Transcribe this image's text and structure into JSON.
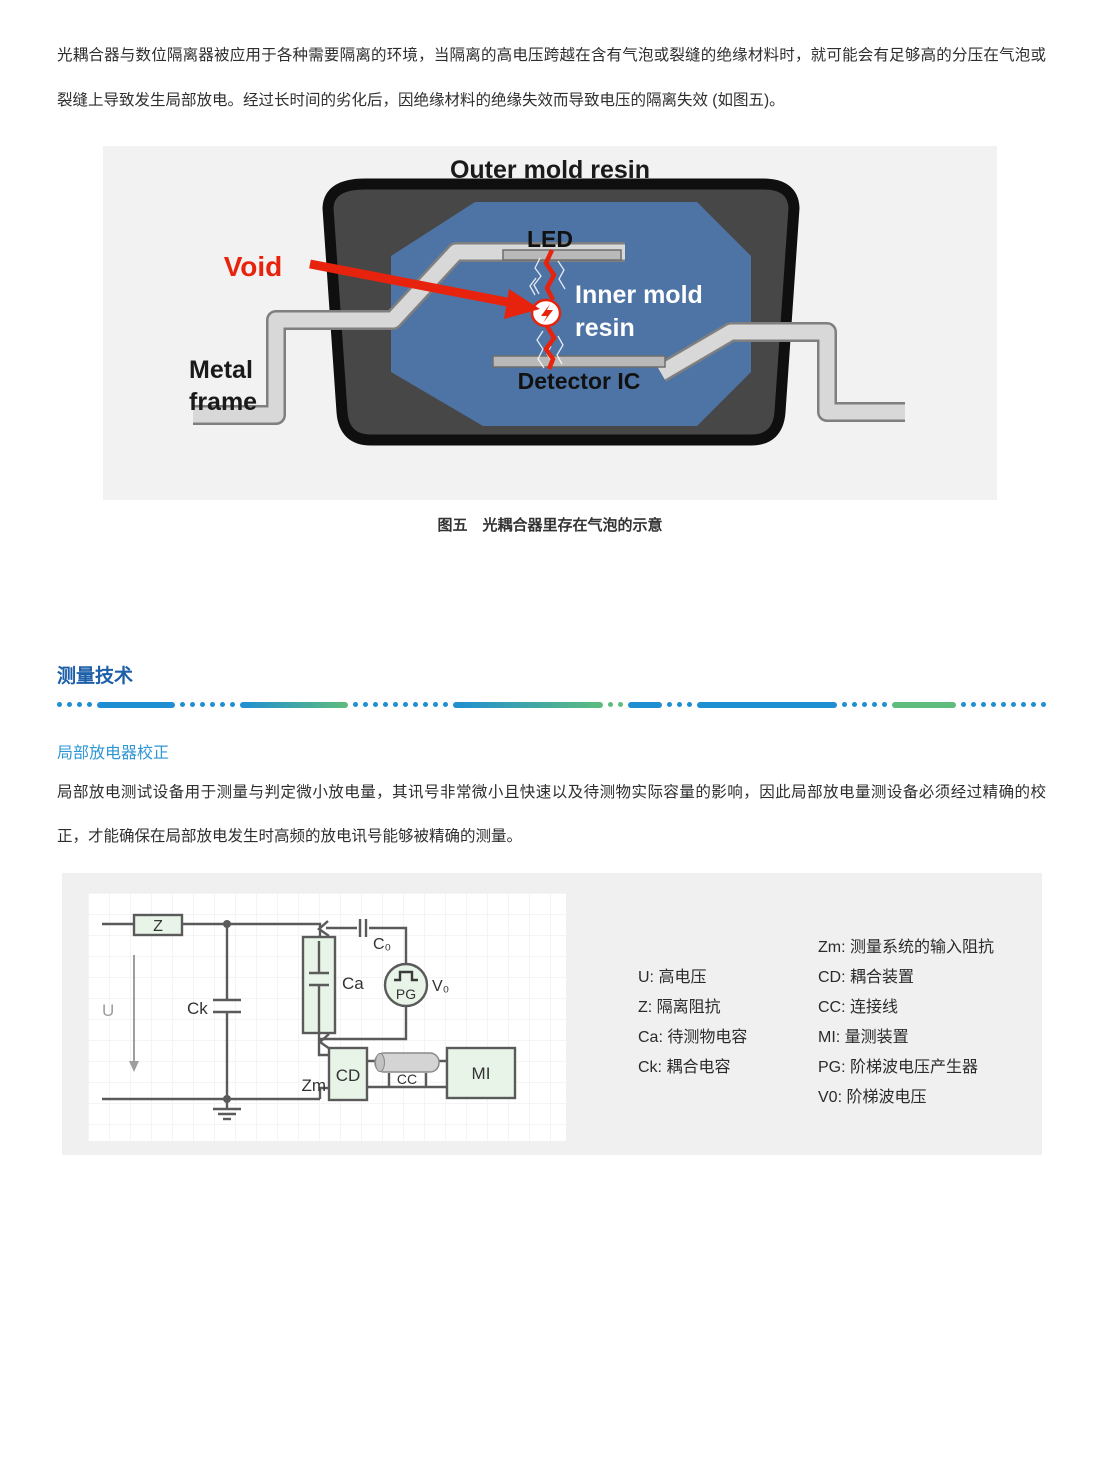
{
  "colors": {
    "section_blue": "#1d5fa9",
    "subsection_blue": "#2e96d5",
    "divider_blue": "#1f8fd2",
    "divider_green": "#5fbc7d",
    "figure_panel_gray": "#f2f2f2",
    "package_dark": "#474747",
    "inner_mold_blue": "#4d74a5",
    "metal_gray": "#d8d8d8",
    "alert_red": "#e8230d",
    "circuit_panel_gray": "#f0f0f0",
    "component_green": "#e9f4e8",
    "wire_gray": "#5a5a5a"
  },
  "intro_paragraph": "光耦合器与数位隔离器被应用于各种需要隔离的环境，当隔离的高电压跨越在含有气泡或裂缝的绝缘材料时，就可能会有足够高的分压在气泡或裂缝上导致发生局部放电。经过长时间的劣化后，因绝缘材料的绝缘失效而导致电压的隔离失效 (如图五)。",
  "figure5": {
    "title": "Outer mold resin",
    "led": "LED",
    "void": "Void",
    "inner_line1": "Inner mold",
    "inner_line2": "resin",
    "metal_line1": "Metal",
    "metal_line2": "frame",
    "detector": "Detector IC",
    "caption": "图五　光耦合器里存在气泡的示意"
  },
  "section": {
    "title": "测量技术",
    "subtitle": "局部放电器校正",
    "paragraph": "局部放电测试设备用于测量与判定微小放电量，其讯号非常微小且快速以及待测物实际容量的影响，因此局部放电量测设备必须经过精确的校正，才能确保在局部放电发生时高频的放电讯号能够被精确的测量。"
  },
  "circuit": {
    "z": "Z",
    "u": "U",
    "ck": "Ck",
    "ca": "Ca",
    "c0": "C₀",
    "pg": "PG",
    "v0": "V₀",
    "zm": "Zm",
    "cd": "CD",
    "cc": "CC",
    "mi": "MI"
  },
  "legend": {
    "left": [
      {
        "text": "U: 高电压"
      },
      {
        "text": "Z: 隔离阻抗"
      },
      {
        "text": "Ca: 待测物电容"
      },
      {
        "text": "Ck: 耦合电容"
      }
    ],
    "right": [
      {
        "text": "Zm: 测量系统的输入阻抗"
      },
      {
        "text": "CD:  耦合装置"
      },
      {
        "text": "CC: 连接线"
      },
      {
        "text": "MI: 量测装置"
      },
      {
        "text": "PG: 阶梯波电压产生器"
      },
      {
        "text": "V0: 阶梯波电压"
      }
    ]
  }
}
